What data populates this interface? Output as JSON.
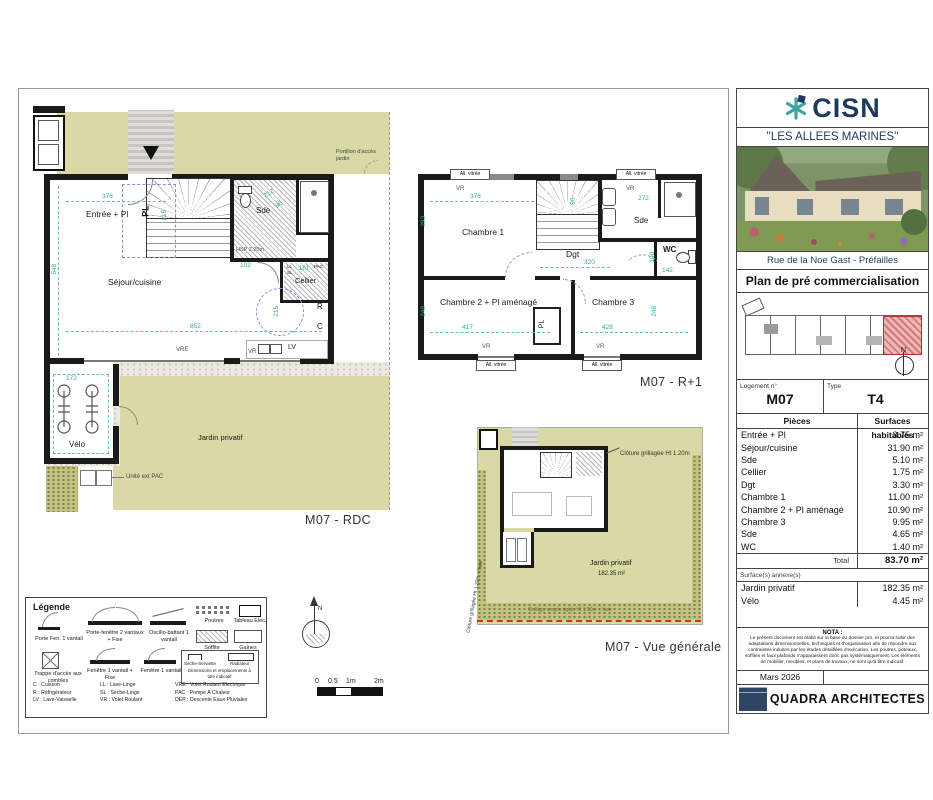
{
  "sheet": {
    "rdc": {
      "caption": "M07 - RDC",
      "entree": "Entrée + Pl",
      "sejour": "Séjour/cuisine",
      "sde": "Sde",
      "cellier": "Cellier",
      "velo": "Vélo",
      "jardin": "Jardin privatif",
      "pl": "PL",
      "r": "R",
      "c": "C",
      "lv": "LV",
      "ll": "LL",
      "sl": "SL",
      "pac": "PAC",
      "vre": "VRE",
      "vr": "VR",
      "hsp": "HSP 2.20m",
      "pac_unit": "Unité ext PAC",
      "portillon": "Portillon d'accès jardin",
      "d376": "376",
      "d215": "215",
      "d548": "548",
      "d852": "852",
      "d212": "212",
      "d96": "96",
      "d102": "102",
      "d161": "161",
      "d172": "172",
      "d215b": "215"
    },
    "r1": {
      "caption": "M07 - R+1",
      "ch1": "Chambre 1",
      "ch2": "Chambre 2 + Pl aménagé",
      "ch3": "Chambre 3",
      "dgt": "Dgt",
      "sde": "Sde",
      "wc": "WC",
      "pl": "PL",
      "vr": "VR",
      "allv": "All. vitrée",
      "d376": "376",
      "d293": "293",
      "d272": "272",
      "d96": "96",
      "d320": "320",
      "d100": "100",
      "d142": "142",
      "d417": "417",
      "d428": "428",
      "d248": "248"
    },
    "vue": {
      "caption": "M07 - Vue générale",
      "jardin": "Jardin privatif",
      "area": "182.35 m²",
      "cloture": "Clôture grillagée Ht 1.20m",
      "cloture_left": "Clôture grillagée Ht 1.20m + haie",
      "grillage": "Grillage souple rigide Ht 1.50m + haie"
    },
    "north": "N",
    "scale": {
      "t0": "0",
      "t05": "0.5",
      "t1": "1m",
      "t2": "2m"
    }
  },
  "legend": {
    "title": "Légende",
    "porte_fen": "Porte Fen. 1 vantail",
    "pf2": "Porte-fenêtre 2 vantaux + Fixe",
    "ob": "Oscillo-battant 1 vantail",
    "poutres": "Poutres",
    "tableau": "Tableau Elec.",
    "soffite": "Soffite",
    "gaines": "Gaines",
    "trappe": "Trappe d'accès aux combles",
    "f1f": "Fenêtre 1 vantail + Fixe",
    "f1": "Fenêtre 1 vantail",
    "ss": "Sèche-Serviette",
    "rad": "Radiateur",
    "note": "Dimensions et emplacements à titre indicatif",
    "abbr1": [
      "C : Cuisson",
      "R : Réfrigérateur",
      "LV : Lave-Vaisselle"
    ],
    "abbr2": [
      "LL : Lave-Linge",
      "SL : Sèche-Linge",
      "VR : Volet Roulant"
    ],
    "abbr3": [
      "VRE : Volet Roulant Electrique",
      "PAC : Pompe A Chaleur",
      "DEP : Descente Eaux Pluviales"
    ]
  },
  "panel": {
    "brand": "CISN",
    "project": "''LES ALLEES MARINES''",
    "address": "Rue de la Noe Gast - Préfailles",
    "doc_title": "Plan de pré commercialisation",
    "north": "N",
    "logement_label": "Logement n°",
    "logement_value": "M07",
    "type_label": "Type",
    "type_value": "T4",
    "col_pieces": "Pièces",
    "col_surfaces": "Surfaces habitables",
    "rows": [
      {
        "label": "Entrée + Pl",
        "value": "3.75 m²"
      },
      {
        "label": "Séjour/cuisine",
        "value": "31.90 m²"
      },
      {
        "label": "Sde",
        "value": "5.10 m²"
      },
      {
        "label": "Cellier",
        "value": "1.75 m²"
      },
      {
        "label": "Dgt",
        "value": "3.30 m²"
      },
      {
        "label": "Chambre 1",
        "value": "11.00 m²"
      },
      {
        "label": "Chambre 2 + Pl aménagé",
        "value": "10.90 m²"
      },
      {
        "label": "Chambre 3",
        "value": "9.95 m²"
      },
      {
        "label": "Sde",
        "value": "4.65 m²"
      },
      {
        "label": "WC",
        "value": "1.40 m²"
      }
    ],
    "total_label": "Total",
    "total_value": "83.70 m²",
    "annex_title": "Surface(s) annexe(s)",
    "annex_rows": [
      {
        "label": "Jardin privatif",
        "value": "182.35 m²"
      },
      {
        "label": "Vélo",
        "value": "4.45 m²"
      }
    ],
    "nota_title": "NOTA :",
    "nota_text": "Le présent document est établi sur la base du dossier pro, et pourra subir des adaptations dimensionnelles, techniques et d'organisation afin de répondre aux contraintes induites par les études détaillées d'exécution. Les poutres, poteaux, soffites et faux plafonds n'apparaissent donc pas systématiquement. Les éléments de mobilier, meubles, et plans de travaux, ne sont qu'à titre indicatif.",
    "date": "Mars 2026",
    "architect": "QUADRA ARCHITECTES"
  }
}
